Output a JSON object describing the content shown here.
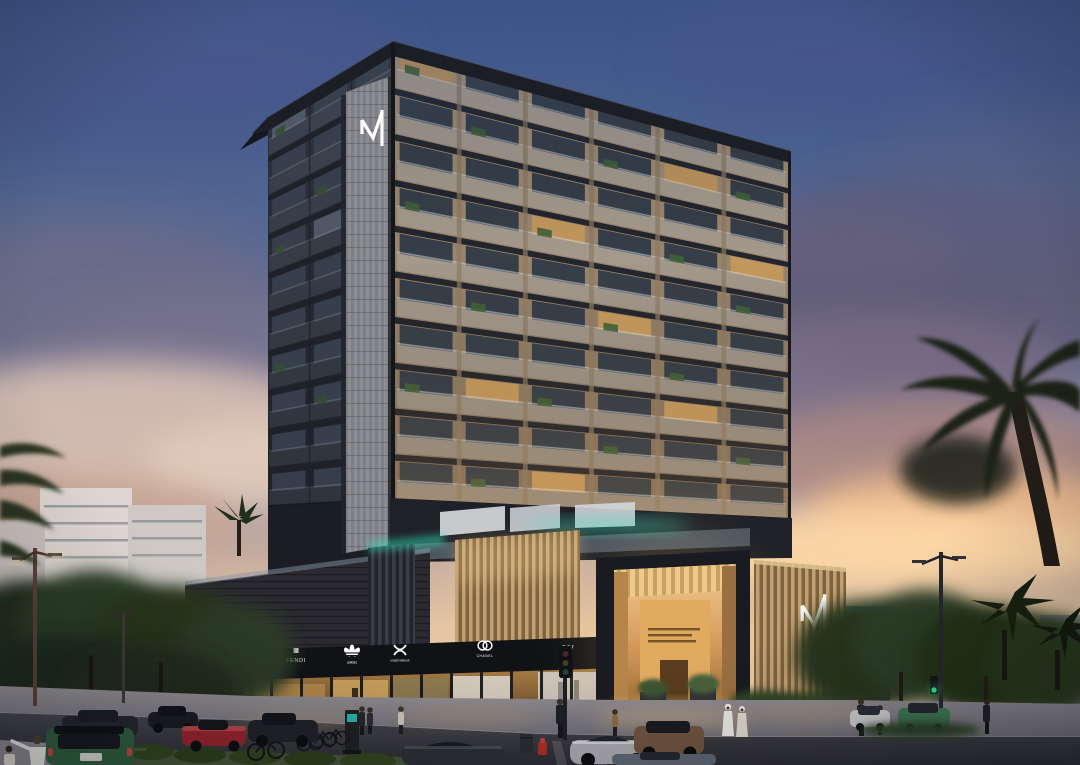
{
  "scene": {
    "title": "Luxury residential tower with retail podium — dusk architectural rendering",
    "time_of_day": "dusk"
  },
  "branding": {
    "tower_logo_mark": "M",
    "podium_logo_mark": "M",
    "logo_color": "#ffffff"
  },
  "tower": {
    "floors": 10,
    "front_bays": 6,
    "side_bays": 3,
    "colors": {
      "slab": "#23262d",
      "window": "#2e3845",
      "window_lit": "#c79a5c",
      "side_window": "#46505f",
      "side_window_lit": "#6a7487",
      "railing": "#bcc9d5",
      "plant": "#41603a",
      "mullion": "#8d7a62",
      "side_mullion": "#20242d",
      "core": "#86888d",
      "roof": "#1b1e24"
    }
  },
  "podium": {
    "shops": [
      {
        "label": "FENDI",
        "icon": "fendi-wordmark"
      },
      {
        "label": "adidas",
        "icon": "adidas-trefoil"
      },
      {
        "label": "UNDER ARMOUR",
        "icon": "under-armour-logo"
      },
      {
        "label": "CHANEL",
        "icon": "chanel-cc-logo"
      },
      {
        "label": "LV",
        "icon": "louis-vuitton-monogram"
      }
    ],
    "accent_light": "#35e3c0",
    "entrance_glow": "#f2c275",
    "gold_slat": "#c2a072",
    "dark_wall": "#2b2a30"
  },
  "street": {
    "signal_green": "#35e58e",
    "vehicles": [
      {
        "name": "dark-sedan",
        "color": "#25272d"
      },
      {
        "name": "black-coupe",
        "color": "#1a1c21"
      },
      {
        "name": "green-suv",
        "color": "#2f5f3e"
      },
      {
        "name": "red-sports-car",
        "color": "#96242e"
      },
      {
        "name": "dark-coupe",
        "color": "#202228"
      },
      {
        "name": "dark-sports-car",
        "color": "#2c2e35"
      },
      {
        "name": "silver-sports-car",
        "color": "#a8a8ae"
      },
      {
        "name": "bronze-suv",
        "color": "#6e5340"
      },
      {
        "name": "gray-sedan",
        "color": "#5d6672"
      },
      {
        "name": "white-hatchback",
        "color": "#c9c9cc"
      },
      {
        "name": "green-compact",
        "color": "#3e7653"
      }
    ],
    "pedestrian_styles": [
      "casual",
      "suit",
      "white-robe",
      "cyclist"
    ]
  },
  "sky": {
    "top": "#3d5388",
    "mid": "#7e7f9b",
    "cloud_slate": "#5e5a75",
    "cloud_cream": "#d8c0b2",
    "horizon_glow": "#ffd9a8"
  }
}
